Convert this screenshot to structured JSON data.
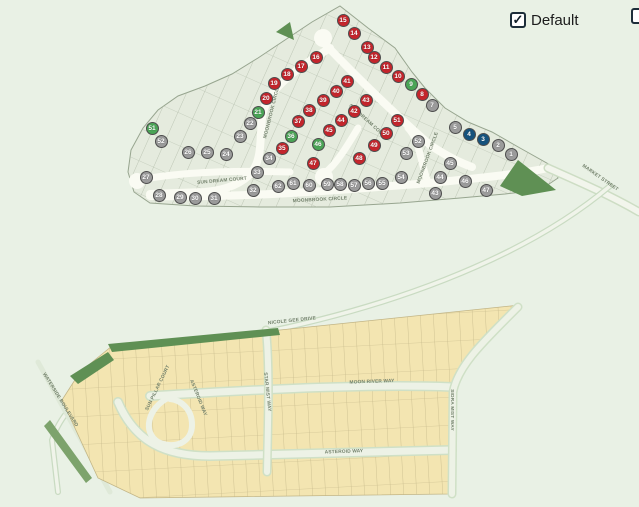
{
  "controls": {
    "default_checkbox": {
      "label": "Default",
      "checked": true
    },
    "secondary_checkbox": {
      "label": "",
      "checked": false
    }
  },
  "status_colors": {
    "sold": "#c4252c",
    "available": "#4aa456",
    "model": "#15527d",
    "unreleased": "#9b9b9b"
  },
  "map": {
    "street_labels": [
      {
        "text": "SUN DREAM COURT",
        "x": 222,
        "y": 181,
        "rot": -5
      },
      {
        "text": "SUN DREAM COURT",
        "x": 368,
        "y": 122,
        "rot": 42
      },
      {
        "text": "MOONBROOK CIRCLE",
        "x": 272,
        "y": 112,
        "rot": -76
      },
      {
        "text": "MOONBROOK CIRCLE",
        "x": 320,
        "y": 200,
        "rot": -3
      },
      {
        "text": "MOONBROOK CIRCLE",
        "x": 428,
        "y": 158,
        "rot": -70
      },
      {
        "text": "MARKET STREET",
        "x": 600,
        "y": 178,
        "rot": 35
      },
      {
        "text": "NICOLE GEE DRIVE",
        "x": 292,
        "y": 321,
        "rot": -6
      },
      {
        "text": "MOON RIVER WAY",
        "x": 372,
        "y": 382,
        "rot": -2
      },
      {
        "text": "ASTEROID WAY",
        "x": 344,
        "y": 452,
        "rot": -2
      },
      {
        "text": "STAR MIST WAY",
        "x": 267,
        "y": 392,
        "rot": 84
      },
      {
        "text": "SIDRA MIST WAY",
        "x": 452,
        "y": 410,
        "rot": 90
      },
      {
        "text": "ASTEROID WAY",
        "x": 198,
        "y": 398,
        "rot": 68
      },
      {
        "text": "SUN PILLAR COURT",
        "x": 158,
        "y": 388,
        "rot": -64
      },
      {
        "text": "WATERSIDE BOULEVARD",
        "x": 60,
        "y": 400,
        "rot": 58
      }
    ],
    "lots": [
      {
        "n": "15",
        "s": "sold",
        "x": 343,
        "y": 20
      },
      {
        "n": "14",
        "s": "sold",
        "x": 354,
        "y": 33
      },
      {
        "n": "13",
        "s": "sold",
        "x": 367,
        "y": 47
      },
      {
        "n": "12",
        "s": "sold",
        "x": 374,
        "y": 57
      },
      {
        "n": "11",
        "s": "sold",
        "x": 386,
        "y": 67
      },
      {
        "n": "10",
        "s": "sold",
        "x": 398,
        "y": 76
      },
      {
        "n": "9",
        "s": "available",
        "x": 411,
        "y": 84
      },
      {
        "n": "8",
        "s": "sold",
        "x": 422,
        "y": 94
      },
      {
        "n": "7",
        "s": "unreleased",
        "x": 432,
        "y": 105
      },
      {
        "n": "5",
        "s": "unreleased",
        "x": 455,
        "y": 127
      },
      {
        "n": "4",
        "s": "model",
        "x": 469,
        "y": 134
      },
      {
        "n": "3",
        "s": "model",
        "x": 483,
        "y": 139
      },
      {
        "n": "2",
        "s": "unreleased",
        "x": 498,
        "y": 145
      },
      {
        "n": "1",
        "s": "unreleased",
        "x": 511,
        "y": 154
      },
      {
        "n": "16",
        "s": "sold",
        "x": 316,
        "y": 57
      },
      {
        "n": "17",
        "s": "sold",
        "x": 301,
        "y": 66
      },
      {
        "n": "18",
        "s": "sold",
        "x": 287,
        "y": 74
      },
      {
        "n": "19",
        "s": "sold",
        "x": 274,
        "y": 83
      },
      {
        "n": "20",
        "s": "sold",
        "x": 266,
        "y": 98
      },
      {
        "n": "21",
        "s": "available",
        "x": 258,
        "y": 112
      },
      {
        "n": "22",
        "s": "unreleased",
        "x": 250,
        "y": 123
      },
      {
        "n": "23",
        "s": "unreleased",
        "x": 240,
        "y": 136
      },
      {
        "n": "24",
        "s": "unreleased",
        "x": 226,
        "y": 154
      },
      {
        "n": "25",
        "s": "unreleased",
        "x": 207,
        "y": 152
      },
      {
        "n": "26",
        "s": "unreleased",
        "x": 188,
        "y": 152
      },
      {
        "n": "27",
        "s": "unreleased",
        "x": 146,
        "y": 177
      },
      {
        "n": "28",
        "s": "unreleased",
        "x": 159,
        "y": 195
      },
      {
        "n": "29",
        "s": "unreleased",
        "x": 180,
        "y": 197
      },
      {
        "n": "30",
        "s": "unreleased",
        "x": 195,
        "y": 198
      },
      {
        "n": "31",
        "s": "unreleased",
        "x": 214,
        "y": 198
      },
      {
        "n": "32",
        "s": "unreleased",
        "x": 253,
        "y": 190
      },
      {
        "n": "33",
        "s": "unreleased",
        "x": 257,
        "y": 172
      },
      {
        "n": "34",
        "s": "unreleased",
        "x": 269,
        "y": 158
      },
      {
        "n": "35",
        "s": "sold",
        "x": 282,
        "y": 148
      },
      {
        "n": "36",
        "s": "available",
        "x": 291,
        "y": 136
      },
      {
        "n": "37",
        "s": "sold",
        "x": 298,
        "y": 121
      },
      {
        "n": "38",
        "s": "sold",
        "x": 309,
        "y": 110
      },
      {
        "n": "39",
        "s": "sold",
        "x": 323,
        "y": 100
      },
      {
        "n": "40",
        "s": "sold",
        "x": 336,
        "y": 91
      },
      {
        "n": "41",
        "s": "sold",
        "x": 347,
        "y": 81
      },
      {
        "n": "43",
        "s": "sold",
        "x": 366,
        "y": 100
      },
      {
        "n": "42",
        "s": "sold",
        "x": 354,
        "y": 111
      },
      {
        "n": "44",
        "s": "sold",
        "x": 341,
        "y": 120
      },
      {
        "n": "45",
        "s": "sold",
        "x": 329,
        "y": 130
      },
      {
        "n": "46",
        "s": "available",
        "x": 318,
        "y": 144
      },
      {
        "n": "47",
        "s": "sold",
        "x": 313,
        "y": 163
      },
      {
        "n": "48",
        "s": "sold",
        "x": 359,
        "y": 158
      },
      {
        "n": "49",
        "s": "sold",
        "x": 374,
        "y": 145
      },
      {
        "n": "50",
        "s": "sold",
        "x": 386,
        "y": 133
      },
      {
        "n": "51",
        "s": "sold",
        "x": 397,
        "y": 120
      },
      {
        "n": "52",
        "s": "unreleased",
        "x": 418,
        "y": 141
      },
      {
        "n": "53",
        "s": "unreleased",
        "x": 406,
        "y": 153
      },
      {
        "n": "54",
        "s": "unreleased",
        "x": 401,
        "y": 177
      },
      {
        "n": "55",
        "s": "unreleased",
        "x": 382,
        "y": 183
      },
      {
        "n": "56",
        "s": "unreleased",
        "x": 368,
        "y": 183
      },
      {
        "n": "57",
        "s": "unreleased",
        "x": 354,
        "y": 185
      },
      {
        "n": "58",
        "s": "unreleased",
        "x": 340,
        "y": 184
      },
      {
        "n": "59",
        "s": "unreleased",
        "x": 327,
        "y": 184
      },
      {
        "n": "60",
        "s": "unreleased",
        "x": 309,
        "y": 185
      },
      {
        "n": "61",
        "s": "unreleased",
        "x": 293,
        "y": 183
      },
      {
        "n": "62",
        "s": "unreleased",
        "x": 278,
        "y": 186
      },
      {
        "n": "45",
        "s": "unreleased",
        "x": 450,
        "y": 163
      },
      {
        "n": "44",
        "s": "unreleased",
        "x": 440,
        "y": 177
      },
      {
        "n": "43",
        "s": "unreleased",
        "x": 435,
        "y": 193
      },
      {
        "n": "46",
        "s": "unreleased",
        "x": 465,
        "y": 181
      },
      {
        "n": "47",
        "s": "unreleased",
        "x": 486,
        "y": 190
      },
      {
        "n": "51",
        "s": "available",
        "x": 152,
        "y": 128
      },
      {
        "n": "52",
        "s": "unreleased",
        "x": 161,
        "y": 141
      }
    ]
  }
}
